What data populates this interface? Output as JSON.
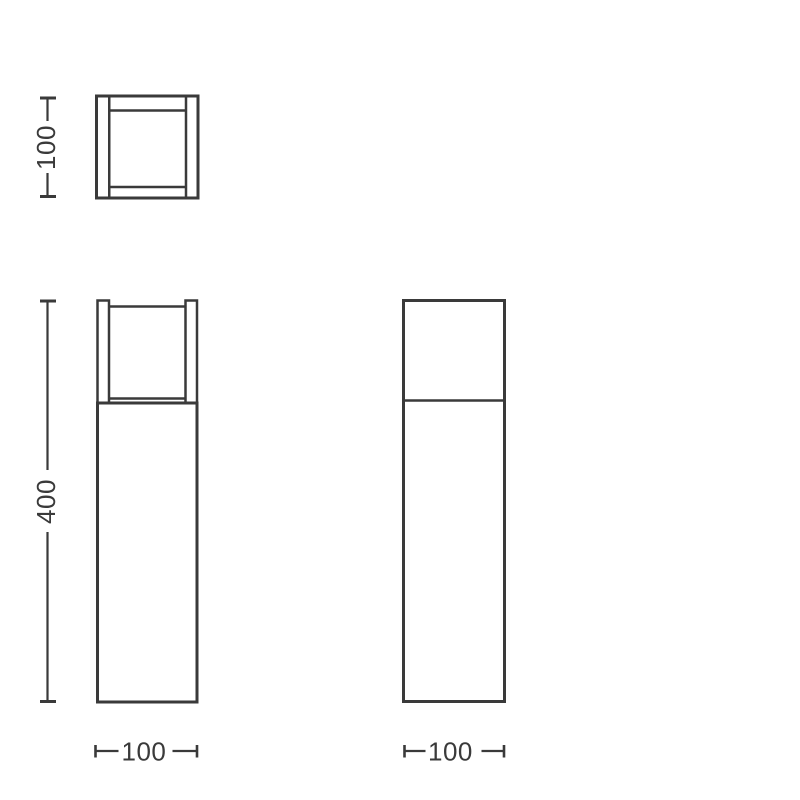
{
  "drawing": {
    "type": "product-dimension-line-drawing",
    "background_color": "#ffffff",
    "line_color": "#3a3a3a",
    "views": {
      "top_view": {
        "height_dimension": {
          "label": "100",
          "orientation": "vertical"
        }
      },
      "front_view": {
        "height_dimension": {
          "label": "400",
          "orientation": "vertical"
        },
        "width_dimension": {
          "label": "100",
          "orientation": "horizontal"
        }
      },
      "side_view": {
        "width_dimension": {
          "label": "100",
          "orientation": "horizontal"
        }
      }
    }
  }
}
